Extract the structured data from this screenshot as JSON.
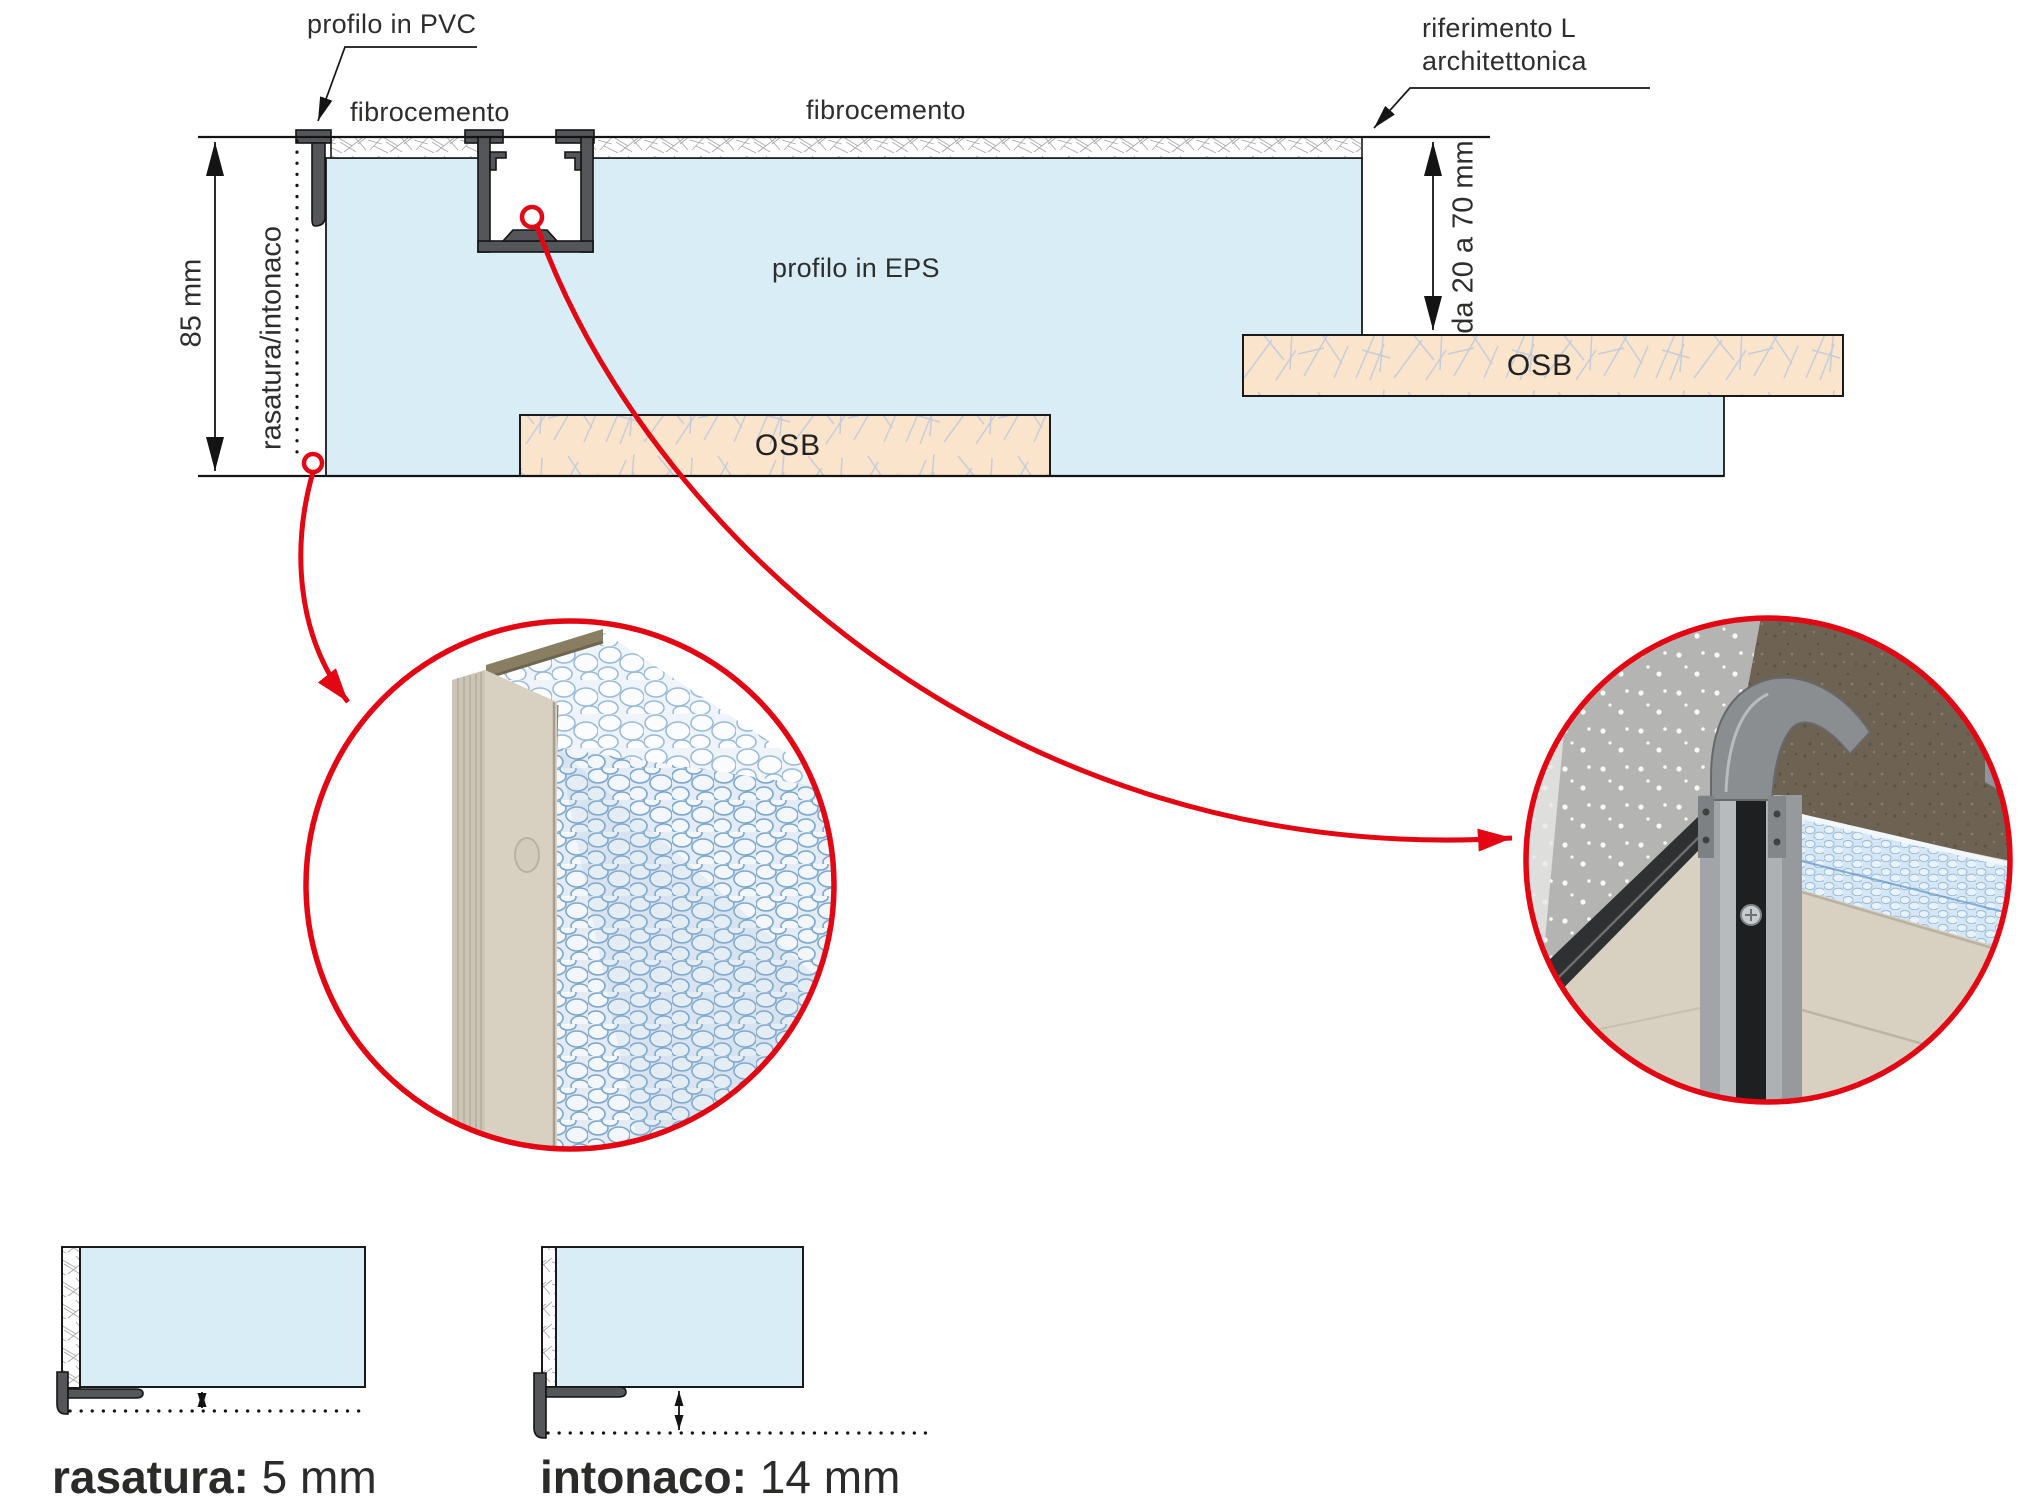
{
  "colors": {
    "accent_red": "#e30613",
    "eps_blue": "#d9edf6",
    "osb_peach": "#fbe4cc",
    "profile_gray": "#54565a",
    "outline_black": "#1a1a1a",
    "text_gray": "#2e2e2d"
  },
  "main_diagram": {
    "callouts": {
      "profilo_pvc": "profilo in PVC",
      "fibrocemento_left": "fibrocemento",
      "fibrocemento_right": "fibrocemento",
      "riferimento_line1": "riferimento L",
      "riferimento_line2": "architettonica",
      "profilo_eps": "profilo in EPS",
      "osb_bottom": "OSB",
      "osb_right": "OSB"
    },
    "dimensions": {
      "total_height": "85 mm",
      "finish_note": "rasatura/intonaco",
      "step_range": "da 20 a 70 mm"
    }
  },
  "detail_photos": {
    "left": "eps-panel-with-pvc-edge-profile-photo",
    "right": "installed-corner-profile-photo"
  },
  "finish_specs": {
    "rasatura": {
      "label": "rasatura:",
      "value": "5 mm"
    },
    "intonaco": {
      "label": "intonaco:",
      "value": "14 mm"
    }
  }
}
